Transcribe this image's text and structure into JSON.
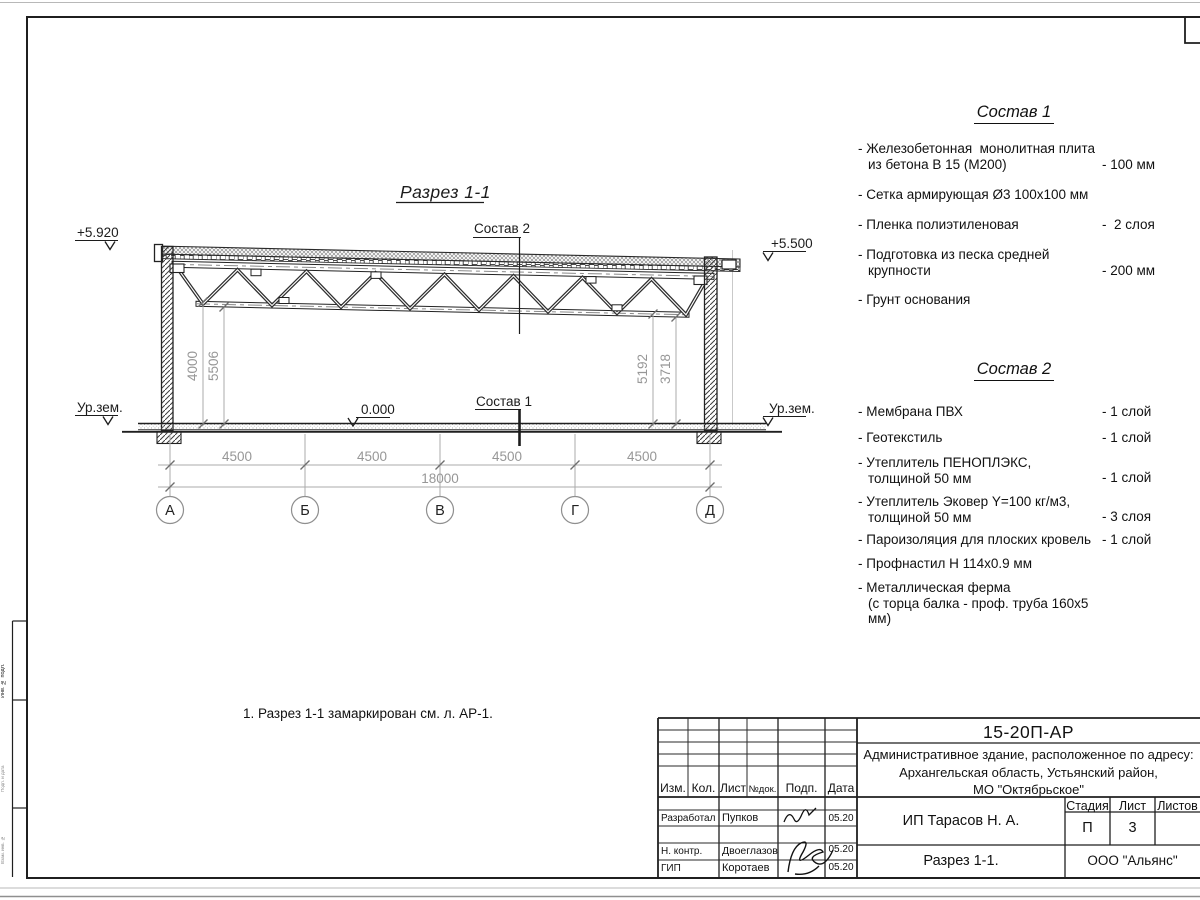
{
  "drawing": {
    "title": "Разрез 1-1",
    "elev_top_left": "+5.920",
    "elev_top_right": "+5.500",
    "ground_left": "Ур.зем.",
    "ground_right": "Ур.зем.",
    "floor_level": "0.000",
    "label_sostav2": "Состав 2",
    "label_sostav1": "Состав 1",
    "dim_left_1": "4000",
    "dim_left_2": "5506",
    "dim_right_1": "5192",
    "dim_right_2": "3718",
    "dim_bay": [
      "4500",
      "4500",
      "4500",
      "4500"
    ],
    "dim_total": "18000",
    "axes": [
      "А",
      "Б",
      "В",
      "Г",
      "Д"
    ]
  },
  "sostav1": {
    "title": "Состав 1",
    "items": [
      {
        "line1": "- Железобетонная  монолитная плита",
        "line2": "из бетона В 15 (М200)",
        "value": "- 100 мм"
      },
      {
        "line1": "- Сетка армирующая Ø3 100х100 мм"
      },
      {
        "line1": "- Пленка полиэтиленовая",
        "value": "-  2 слоя"
      },
      {
        "line1": "- Подготовка из песка средней",
        "line2": "крупности",
        "value": "- 200 мм"
      },
      {
        "line1": "- Грунт основания"
      }
    ]
  },
  "sostav2": {
    "title": "Состав 2",
    "items": [
      {
        "line1": "- Мембрана ПВХ",
        "value": "- 1 слой"
      },
      {
        "line1": "- Геотекстиль",
        "value": "- 1 слой"
      },
      {
        "line1": "- Утеплитель ПЕНОПЛЭКС,",
        "line2": "толщиной 50 мм",
        "value": "- 1 слой"
      },
      {
        "line1": "- Утеплитель Эковер Y=100 кг/м3,",
        "line2": "толщиной 50 мм",
        "value": "- 3 слоя"
      },
      {
        "line1": "- Пароизоляция для плоских кровель",
        "value": "- 1 слой"
      },
      {
        "line1": "- Профнастил Н 114х0.9 мм"
      },
      {
        "line1": "- Металлическая ферма",
        "line2": "(с торца балка - проф. труба 160х5 мм)"
      }
    ]
  },
  "note": "1. Разрез 1-1 замаркирован см. л. АР-1.",
  "titleblock": {
    "doc_number": "15-20П-АР",
    "project_line1": "Административное здание, расположенное по адресу:",
    "project_line2": "Архангельская область, Устьянский район,",
    "project_line3": "МО \"Октябрьское\"",
    "columns": [
      "Изм.",
      "Кол.",
      "Лист",
      "№док.",
      "Подп.",
      "Дата"
    ],
    "rows": [
      {
        "role": "Разработал",
        "name": "Пупков",
        "date": "05.20"
      },
      {
        "role": "Н. контр.",
        "name": "Двоеглазов",
        "date": "05.20"
      },
      {
        "role": "ГИП",
        "name": "Коротаев",
        "date": "05.20"
      }
    ],
    "stage_header": [
      "Стадия",
      "Лист",
      "Листов"
    ],
    "stage": "П",
    "sheet": "3",
    "client": "ИП Тарасов Н. А.",
    "sheet_title": "Разрез 1-1.",
    "company": "ООО \"Альянс\""
  },
  "left_stamp": {
    "labels": [
      "Инв. № подл.",
      "Подп. и дата",
      "Взам. инв. №"
    ]
  }
}
